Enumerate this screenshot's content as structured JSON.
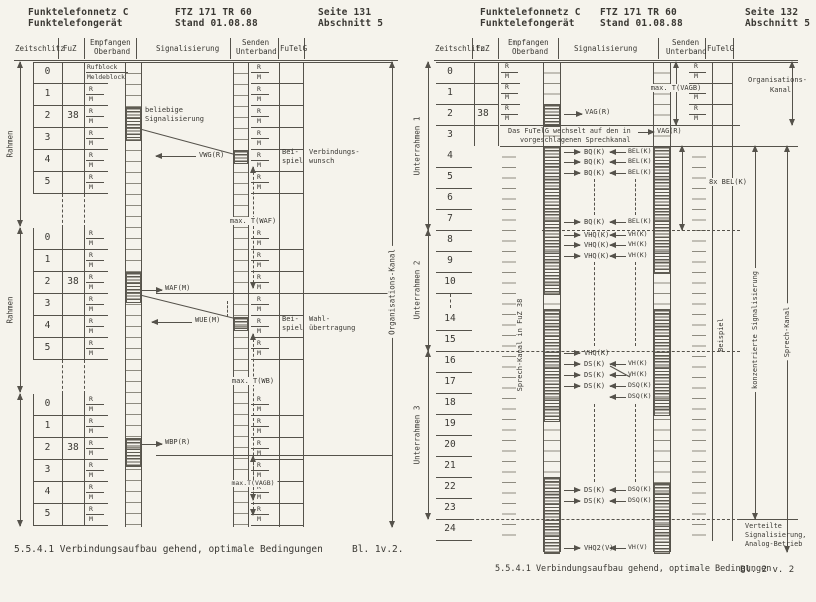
{
  "colors": {
    "paper": "#f5f3ec",
    "ink": "#3a3833",
    "line": "#55524b",
    "hatch": "#5e5b52"
  },
  "left": {
    "header": {
      "org_line1": "Funktelefonnetz C",
      "org_line2": "Funktelefongerät",
      "doc_line1": "FTZ 171 TR 60",
      "doc_line2": "Stand 01.08.88",
      "page_line1": "Seite 131",
      "page_line2": "Abschnitt 5"
    },
    "columns": {
      "zeitschlitz": "Zeitschlitz",
      "fuz": "FuZ",
      "empfangen": "Empfangen",
      "oberband": "Oberband",
      "signalisierung": "Signalisierung",
      "senden": "Senden",
      "unterband": "Unterband",
      "futelg": "FuTelG"
    },
    "rahmen_label": "Rahmen",
    "slot_numbers": [
      "0",
      "1",
      "2",
      "3",
      "4",
      "5"
    ],
    "fuz_value": "38",
    "rufblock": "Rufblock",
    "meldeblock": "Meldeblock",
    "rm": [
      "R",
      "M"
    ],
    "ann": {
      "beliebige_1": "beliebige",
      "beliebige_2": "Signalisierung",
      "vwg": "VWG(R)",
      "beispiel_1": "Bei-",
      "beispiel_2": "spiel",
      "verbindungswunsch_1": "Verbindungs-",
      "verbindungswunsch_2": "wunsch",
      "max_t_waf": "max. T(WAF)",
      "waf": "WAF(M)",
      "wue": "WUE(M)",
      "wahl_1": "Wahl-",
      "wahl_2": "übertragung",
      "max_t_wb": "max. T(WB)",
      "wbp": "WBP(R)",
      "max_t_vagb": "max.T(VAGB)",
      "organisations_kanal": "Organisations-Kanal"
    },
    "caption": "5.5.4.1 Verbindungsaufbau gehend, optimale Bedingungen",
    "sheet": "Bl. 1v.2."
  },
  "right": {
    "header": {
      "org_line1": "Funktelefonnetz C",
      "org_line2": "Funktelefongerät",
      "doc_line1": "FTZ 171 TR 60",
      "doc_line2": "Stand 01.08.88",
      "page_line1": "Seite 132",
      "page_line2": "Abschnitt 5"
    },
    "columns": {
      "zeitschlitz": "Zeitschlitz",
      "fuz": "FuZ",
      "empfangen": "Empfangen",
      "oberband": "Oberband",
      "signalisierung": "Signalisierung",
      "senden": "Senden",
      "unterband": "Unterband",
      "futelg": "FuTelG"
    },
    "unterrahmen": [
      "Unterrahmen 1",
      "Unterrahmen 2",
      "Unterrahmen 3"
    ],
    "slot_numbers": [
      "0",
      "1",
      "2",
      "3",
      "4",
      "5",
      "6",
      "7",
      "8",
      "9",
      "10",
      "14",
      "15",
      "16",
      "17",
      "18",
      "19",
      "20",
      "21",
      "22",
      "23",
      "24"
    ],
    "fuz_value": "38",
    "rm": [
      "R",
      "M"
    ],
    "message": {
      "line1": "Das FuTelG wechselt auf den in",
      "vag": "VAG(R)",
      "line2": "vorgeschlagenen Sprechkanal"
    },
    "ann": {
      "vag": "VAG(R)",
      "max_t_vagb": "max. T(VAGB)",
      "organisations_1": "Organisations-",
      "organisations_2": "Kanal",
      "bq": "BQ(K)",
      "bel": "BEL(K)",
      "bel_8x": "8x BEL(K)",
      "vhq": "VHQ(K)",
      "vh": "VH(K)",
      "ds": "DS(K)",
      "dsq": "DSQ(K)",
      "vhq2": "VHQ2(V)",
      "vh_v": "VH(V)",
      "sprech_kanal_fuz": "Sprech-Kanal in FuZ 38",
      "beispiel": "Beispiel",
      "konzentriert": "konzentrierte Signalisierung",
      "sprech_kanal": "Sprech-Kanal",
      "verteilte_1": "Verteilte",
      "verteilte_2": "Signalisierung,",
      "verteilte_3": "Analog-Betrieb"
    },
    "caption": "5.5.4.1 Verbindungsaufbau gehend, optimale Bedingungen",
    "sheet": "Bl. 2 v. 2"
  }
}
